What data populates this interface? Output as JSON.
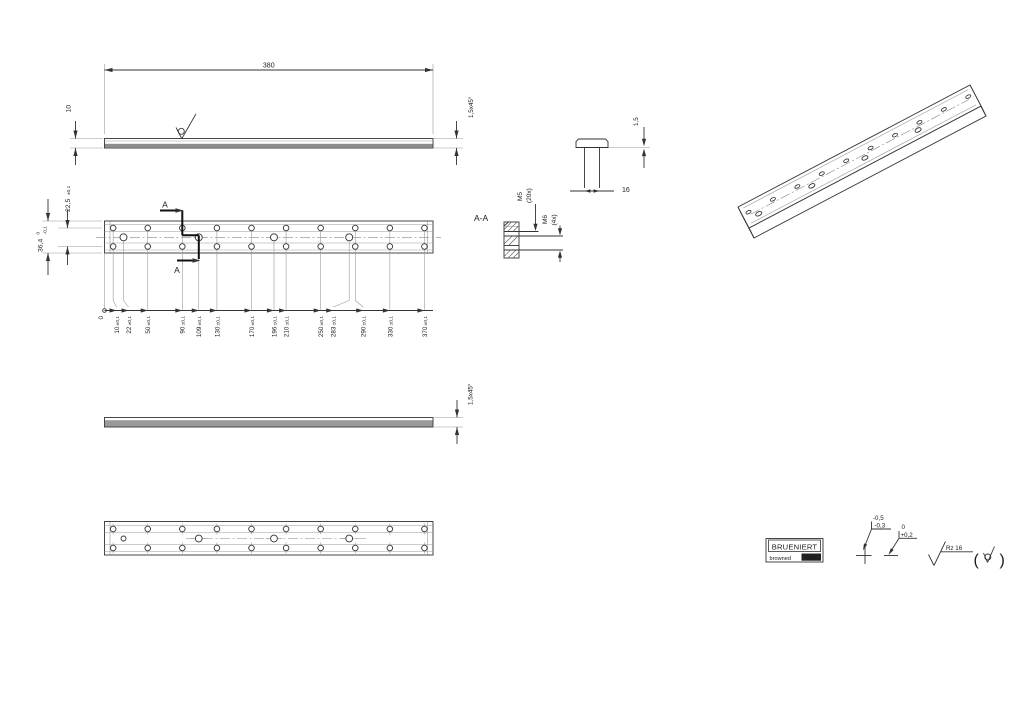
{
  "drawing": {
    "top_view": {
      "length": "380",
      "thickness": "10",
      "chamfer": "1,5x45°"
    },
    "front_view": {
      "height": "36,4",
      "height_tol_upper": "0",
      "height_tol_lower": "-0,1",
      "row_spacing": "22,5",
      "row_spacing_tol": "±0,1",
      "section_letter": "A",
      "ordinate_dims": [
        {
          "value": "0",
          "tol": ""
        },
        {
          "value": "10",
          "tol": "±0,1"
        },
        {
          "value": "22",
          "tol": "±0,1"
        },
        {
          "value": "50",
          "tol": "±0,1"
        },
        {
          "value": "90",
          "tol": "±0,1"
        },
        {
          "value": "109",
          "tol": "±0,1"
        },
        {
          "value": "130",
          "tol": "±0,1"
        },
        {
          "value": "170",
          "tol": "±0,1"
        },
        {
          "value": "196",
          "tol": "±0,1"
        },
        {
          "value": "210",
          "tol": "±0,1"
        },
        {
          "value": "250",
          "tol": "±0,1"
        },
        {
          "value": "283",
          "tol": "±0,1"
        },
        {
          "value": "290",
          "tol": "±0,1"
        },
        {
          "value": "330",
          "tol": "±0,1"
        },
        {
          "value": "370",
          "tol": "±0,1"
        }
      ]
    },
    "section_view": {
      "label": "A-A",
      "thread_small": "M5",
      "thread_small_count": "(20x)",
      "thread_large": "M6",
      "thread_large_count": "(4x)"
    },
    "end_view": {
      "width": "16",
      "edge": "1,5"
    },
    "side_view": {
      "chamfer": "1,5x45°"
    },
    "holes": {
      "m5_positions_mm": [
        10,
        50,
        90,
        130,
        170,
        210,
        250,
        290,
        330,
        370
      ],
      "m6_positions_mm": [
        22,
        109,
        196,
        283
      ]
    },
    "notes": {
      "stamp": {
        "line1": "BRUENIERT",
        "line2": "browned",
        "code": "001"
      },
      "edge_tolerance_1": {
        "upper": "-0,5",
        "lower": "-0,3"
      },
      "edge_tolerance_2": {
        "upper": "0",
        "lower": "+0,2"
      },
      "surface_finish": {
        "value": "Rz  16"
      }
    }
  }
}
